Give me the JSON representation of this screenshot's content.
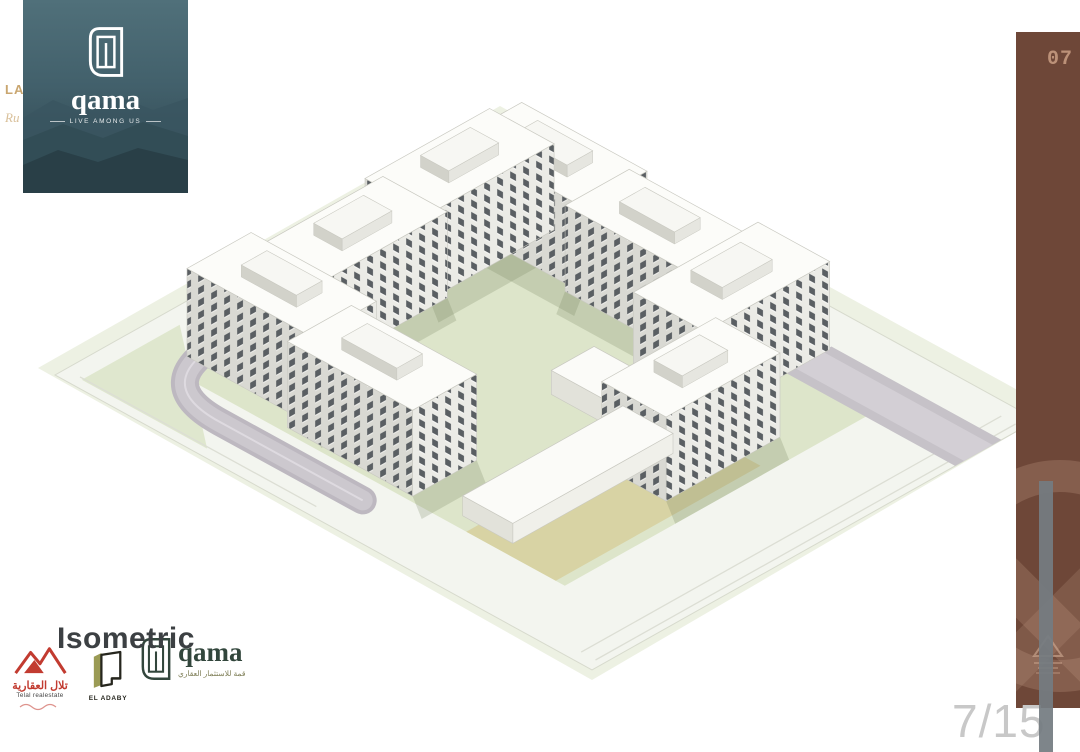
{
  "page": {
    "background": "#FFFFFF",
    "page_indicator": "7/15",
    "section_title": "Isometric"
  },
  "brand_card": {
    "wordmark": "qama",
    "tagline": "LIVE AMONG US",
    "bg_top": "#50707A",
    "bg_bottom": "#2B414A"
  },
  "margin_fragments": {
    "line1": "LA",
    "line2": "Ru"
  },
  "sidebar": {
    "badge": "07",
    "color": "#6E4738",
    "accent": "#C59A80"
  },
  "partners": {
    "telal": {
      "name_ar": "تلال العقارية",
      "name_en": "Telal realestate",
      "color": "#C23B30"
    },
    "eladaby": {
      "name": "EL ADABY",
      "accent": "#9B9B55"
    },
    "qama": {
      "wordmark": "qama",
      "subtitle_ar": "قمة للاستثمار العقاري",
      "color": "#32463C"
    }
  },
  "site_plan": {
    "palette": {
      "margin": "#EDF1E3",
      "base": "#F3F5EF",
      "base_stroke": "#D7DACD",
      "lawn": "#DDE5CA",
      "wedge": "#DFE7CE",
      "plot_tan": "#D8D3A4",
      "road_dark": "#BDB8C0",
      "road_mid": "#CCC8CE",
      "road_center": "#DEDAE0",
      "road_band": "#C6C2C8",
      "road_band_inner": "#D3CFD5",
      "curb": "#DCDED4",
      "roof": "#FCFCF9",
      "face_light": "#EBEBE6",
      "face_dark": "#D9D9D3",
      "win_dark": "#5A5F63",
      "pent_roof": "#F7F7F3",
      "pent_light": "#E6E6E0",
      "pent_dark": "#D2D2CA",
      "club_roof": "#FBFBF8",
      "club_light": "#F0F0EA",
      "club_dark": "#E2E2DA",
      "shadow": "rgba(110,125,88,0.22)",
      "stroke": "#C9C9C1"
    }
  }
}
